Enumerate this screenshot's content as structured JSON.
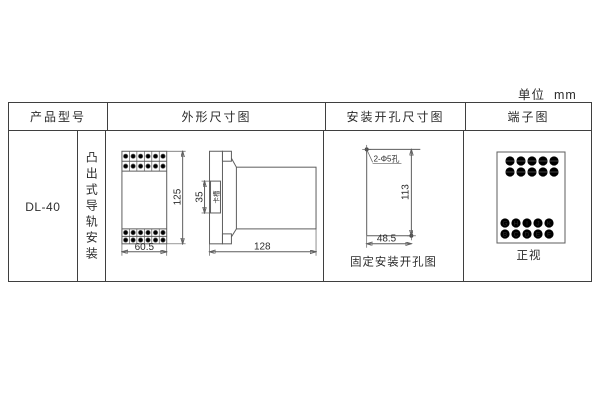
{
  "unit_label": "单位  mm",
  "colors": {
    "line": "#5d5d5d",
    "text": "#2b2b2b",
    "border": "#3f3f3f",
    "background": "#ffffff"
  },
  "table": {
    "headers": {
      "product_model": "产品型号",
      "outline": "外形尺寸图",
      "mounting_holes": "安装开孔尺寸图",
      "terminals": "端子图"
    },
    "product": {
      "model": "DL-40",
      "mounting_type": "凸出式导轨安装"
    }
  },
  "outline_drawing": {
    "front_width": "60.5",
    "height": "125",
    "slot_height": "35",
    "slot_label": "卡槽",
    "depth": "128"
  },
  "hole_drawing": {
    "hole_note": "2-Φ5孔",
    "height": "113",
    "width": "48.5",
    "caption": "固定安装开孔图"
  },
  "terminal_drawing": {
    "row1": [
      "G",
      "H",
      "I",
      "J",
      "K"
    ],
    "row2": [
      "B",
      "C",
      "D",
      "E",
      "F"
    ],
    "caption": "正视"
  }
}
